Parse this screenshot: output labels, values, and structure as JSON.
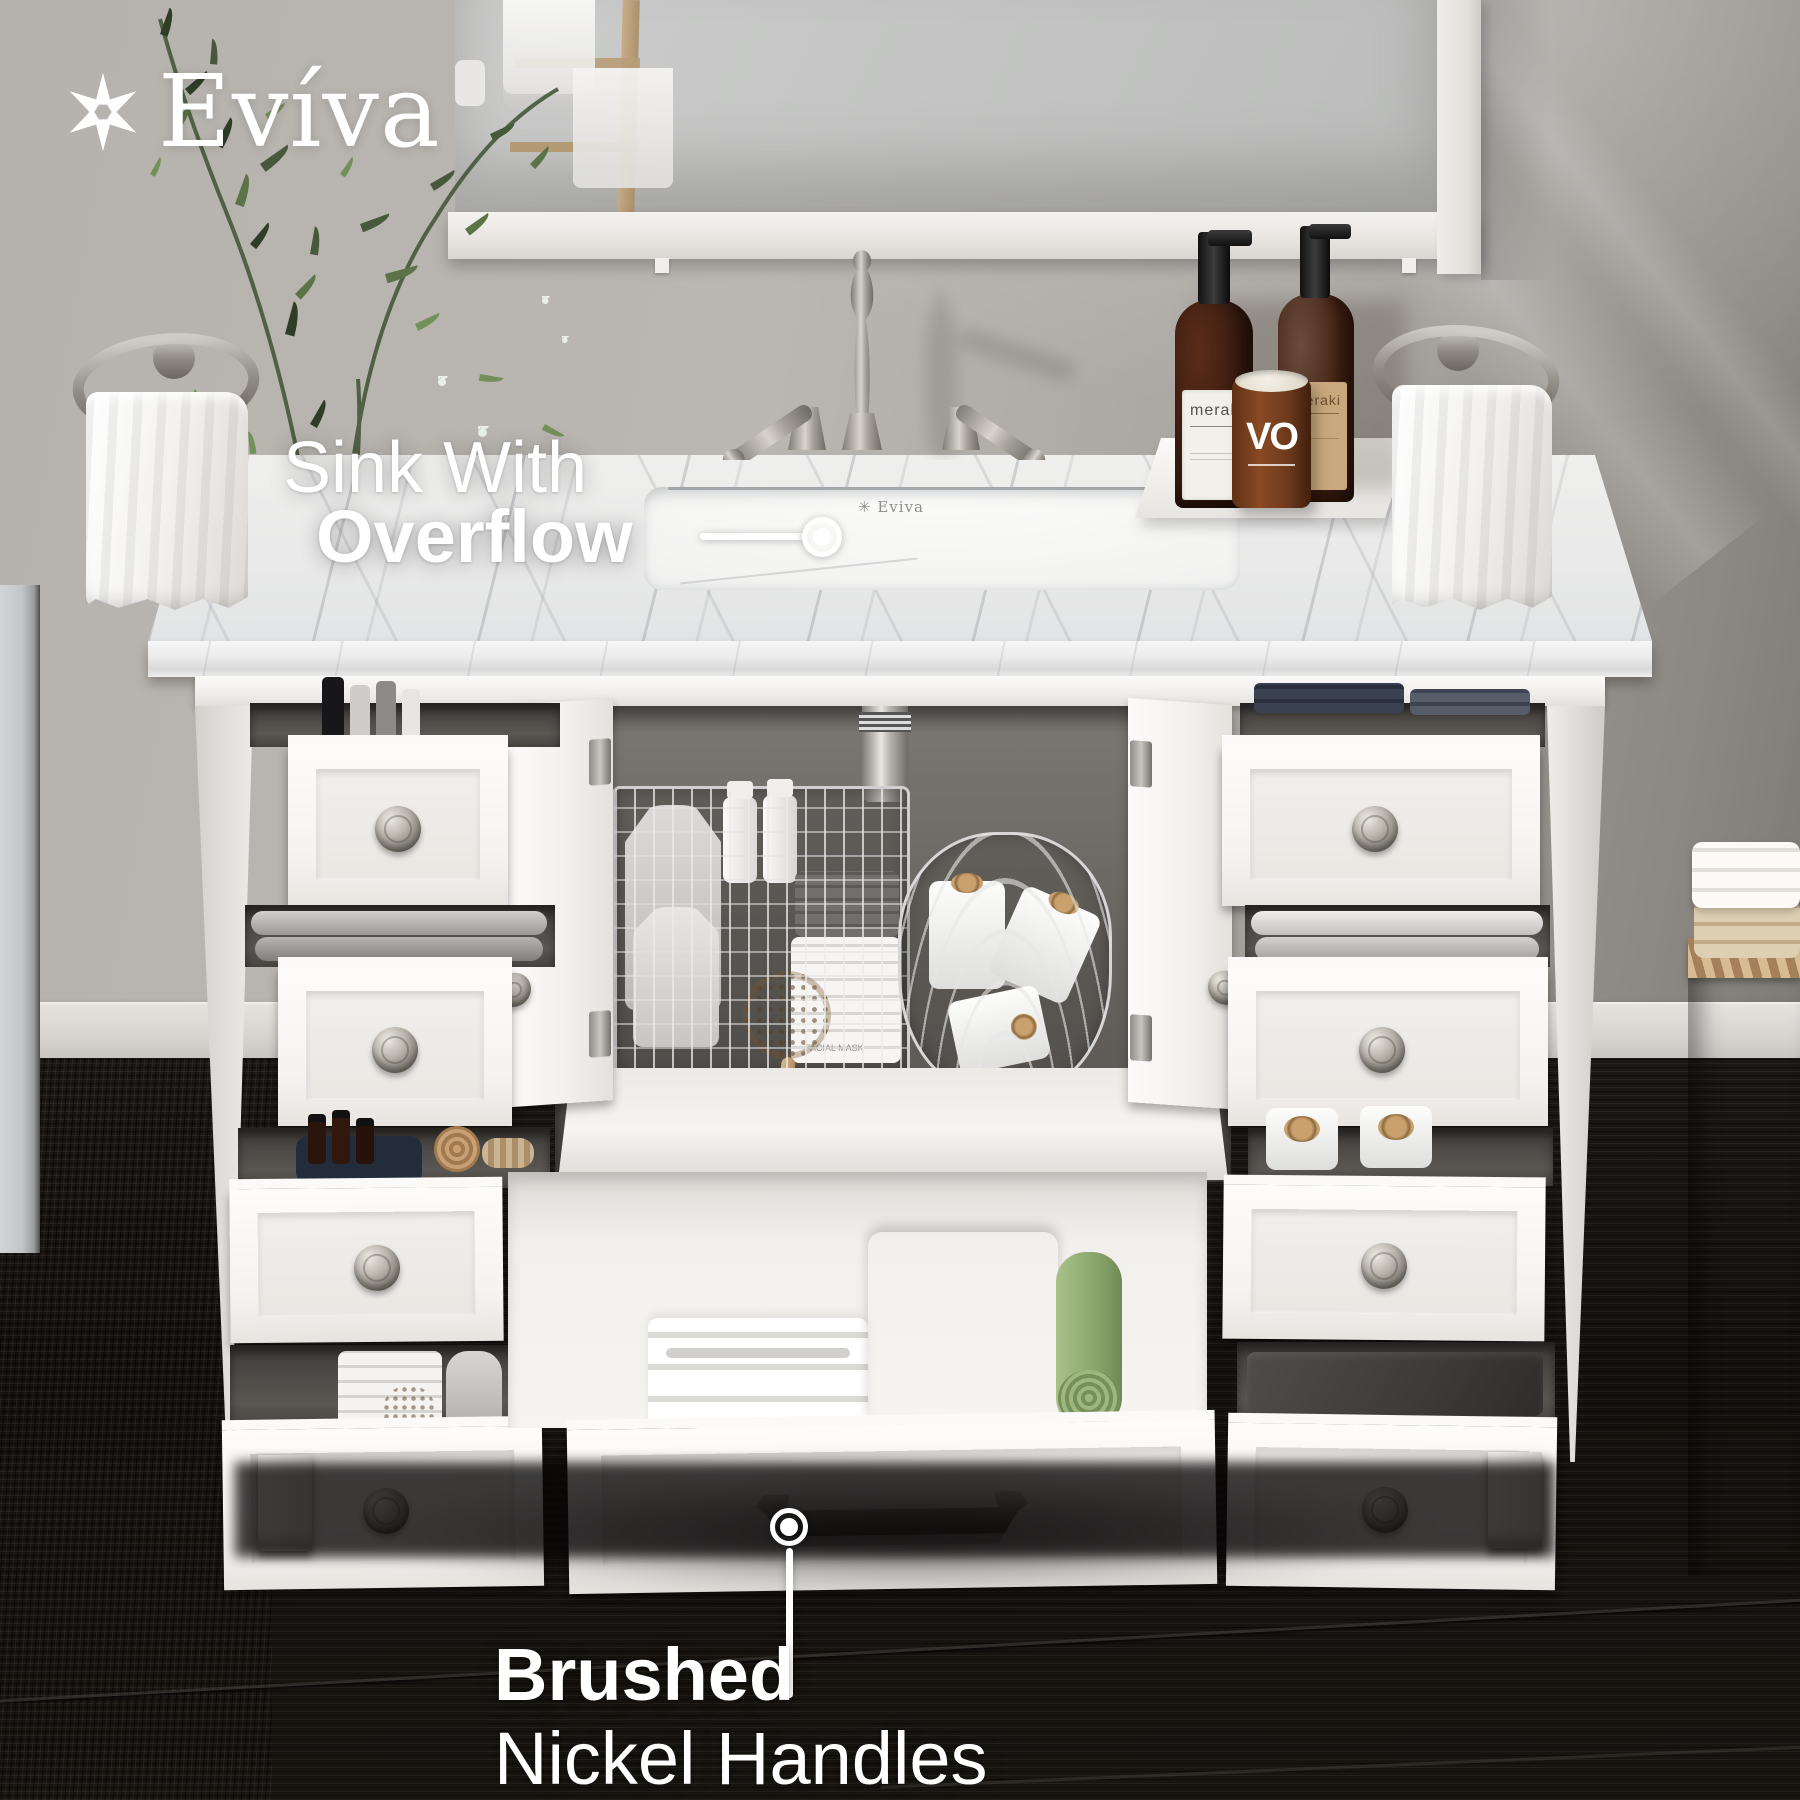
{
  "brand": {
    "logo_text": "Evíva"
  },
  "annotations": {
    "sink": {
      "line1": "Sink With",
      "line2": "Overflow"
    },
    "handles": {
      "line1": "Brushed",
      "line2": "Nickel Handles"
    }
  },
  "sink_print": {
    "text": "Eviva"
  },
  "props": {
    "soap_label": "meraki",
    "soap_label_2": "meraki",
    "candle_label": "VO",
    "facial_mask_label": "FACIAL MASK"
  },
  "palette": {
    "brushed_nickel": "#8f8b84",
    "marble": "#ebebeb",
    "wall": "#b2aeaa",
    "wall_dark": "#87837e",
    "floor": "#171411",
    "vanity_white": "#f7f6f4",
    "wicker": "#c2a078",
    "towel_green": "#9db77f",
    "bottle_amber": "#3a1d12",
    "vase_blue": "#21374c"
  }
}
